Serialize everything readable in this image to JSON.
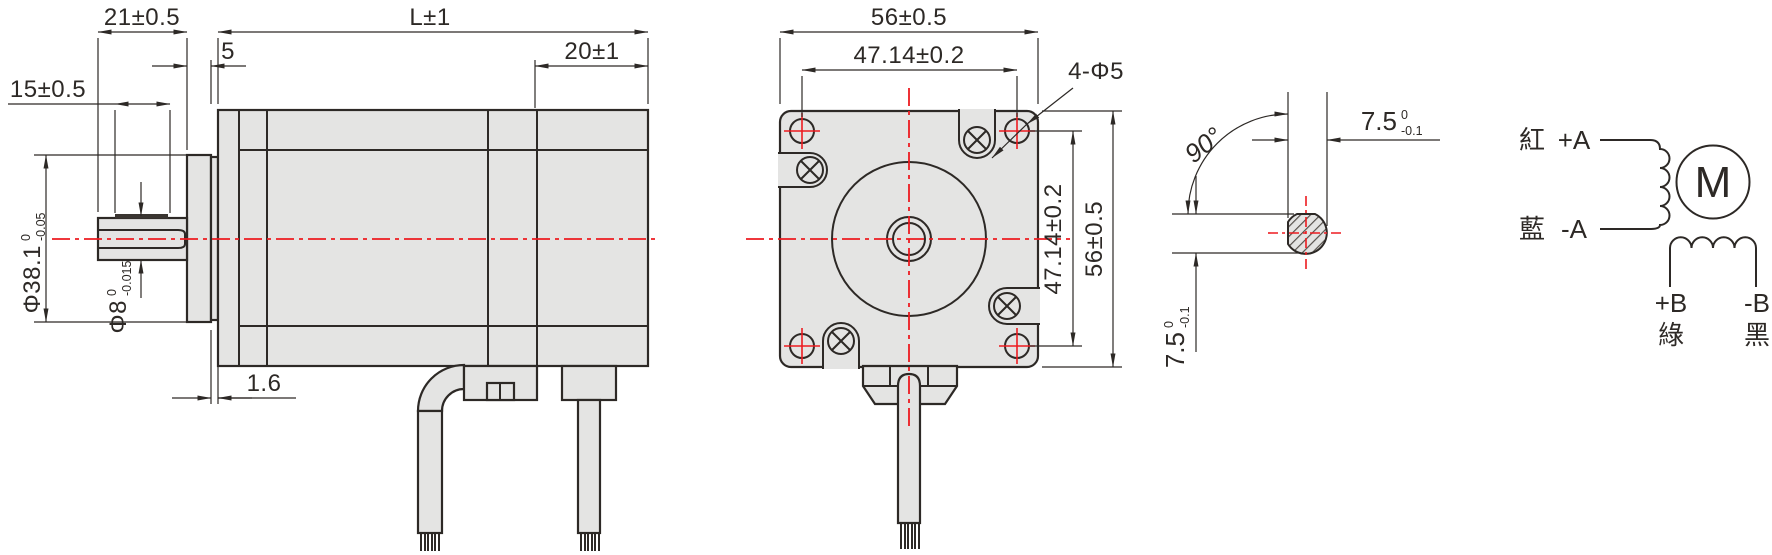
{
  "colors": {
    "accent_red": "#ed1b20",
    "line_color": "#2d2926",
    "body_fill": "#e4e4e3"
  },
  "side_view": {
    "dim_shaft_length": "21±0.5",
    "dim_body_length": "L±1",
    "dim_front_step": "5",
    "dim_rear_section": "20±1",
    "dim_flat_length": "15±0.5",
    "dim_pilot_boss_height": "1.6",
    "dim_pilot_dia": {
      "text": "Φ38.1",
      "sup": "0",
      "sub": "-0.05"
    },
    "dim_shaft_dia": {
      "text": "Φ8",
      "sup": "0",
      "sub": "-0.015"
    }
  },
  "front_view": {
    "dim_width": "56±0.5",
    "dim_hole_spacing_h": "47.14±0.2",
    "dim_hole_spacing_v": "47.14±0.2",
    "dim_height": "56±0.5",
    "label_mounting_holes": "4-Φ5"
  },
  "shaft_section": {
    "dim_angle": "90°",
    "dim_flat_width": {
      "text": "7.5",
      "sup": "0",
      "sub": "-0.1"
    },
    "dim_flat_height": {
      "text": "7.5",
      "sup": "0",
      "sub": "-0.1"
    }
  },
  "wiring_diagram": {
    "motor_symbol": "M",
    "leads": {
      "a_plus": "+A",
      "a_minus": "-A",
      "b_plus": "+B",
      "b_minus": "-B"
    },
    "wire_colors": {
      "red": "紅",
      "blue": "藍",
      "green": "綠",
      "black": "黑"
    }
  }
}
